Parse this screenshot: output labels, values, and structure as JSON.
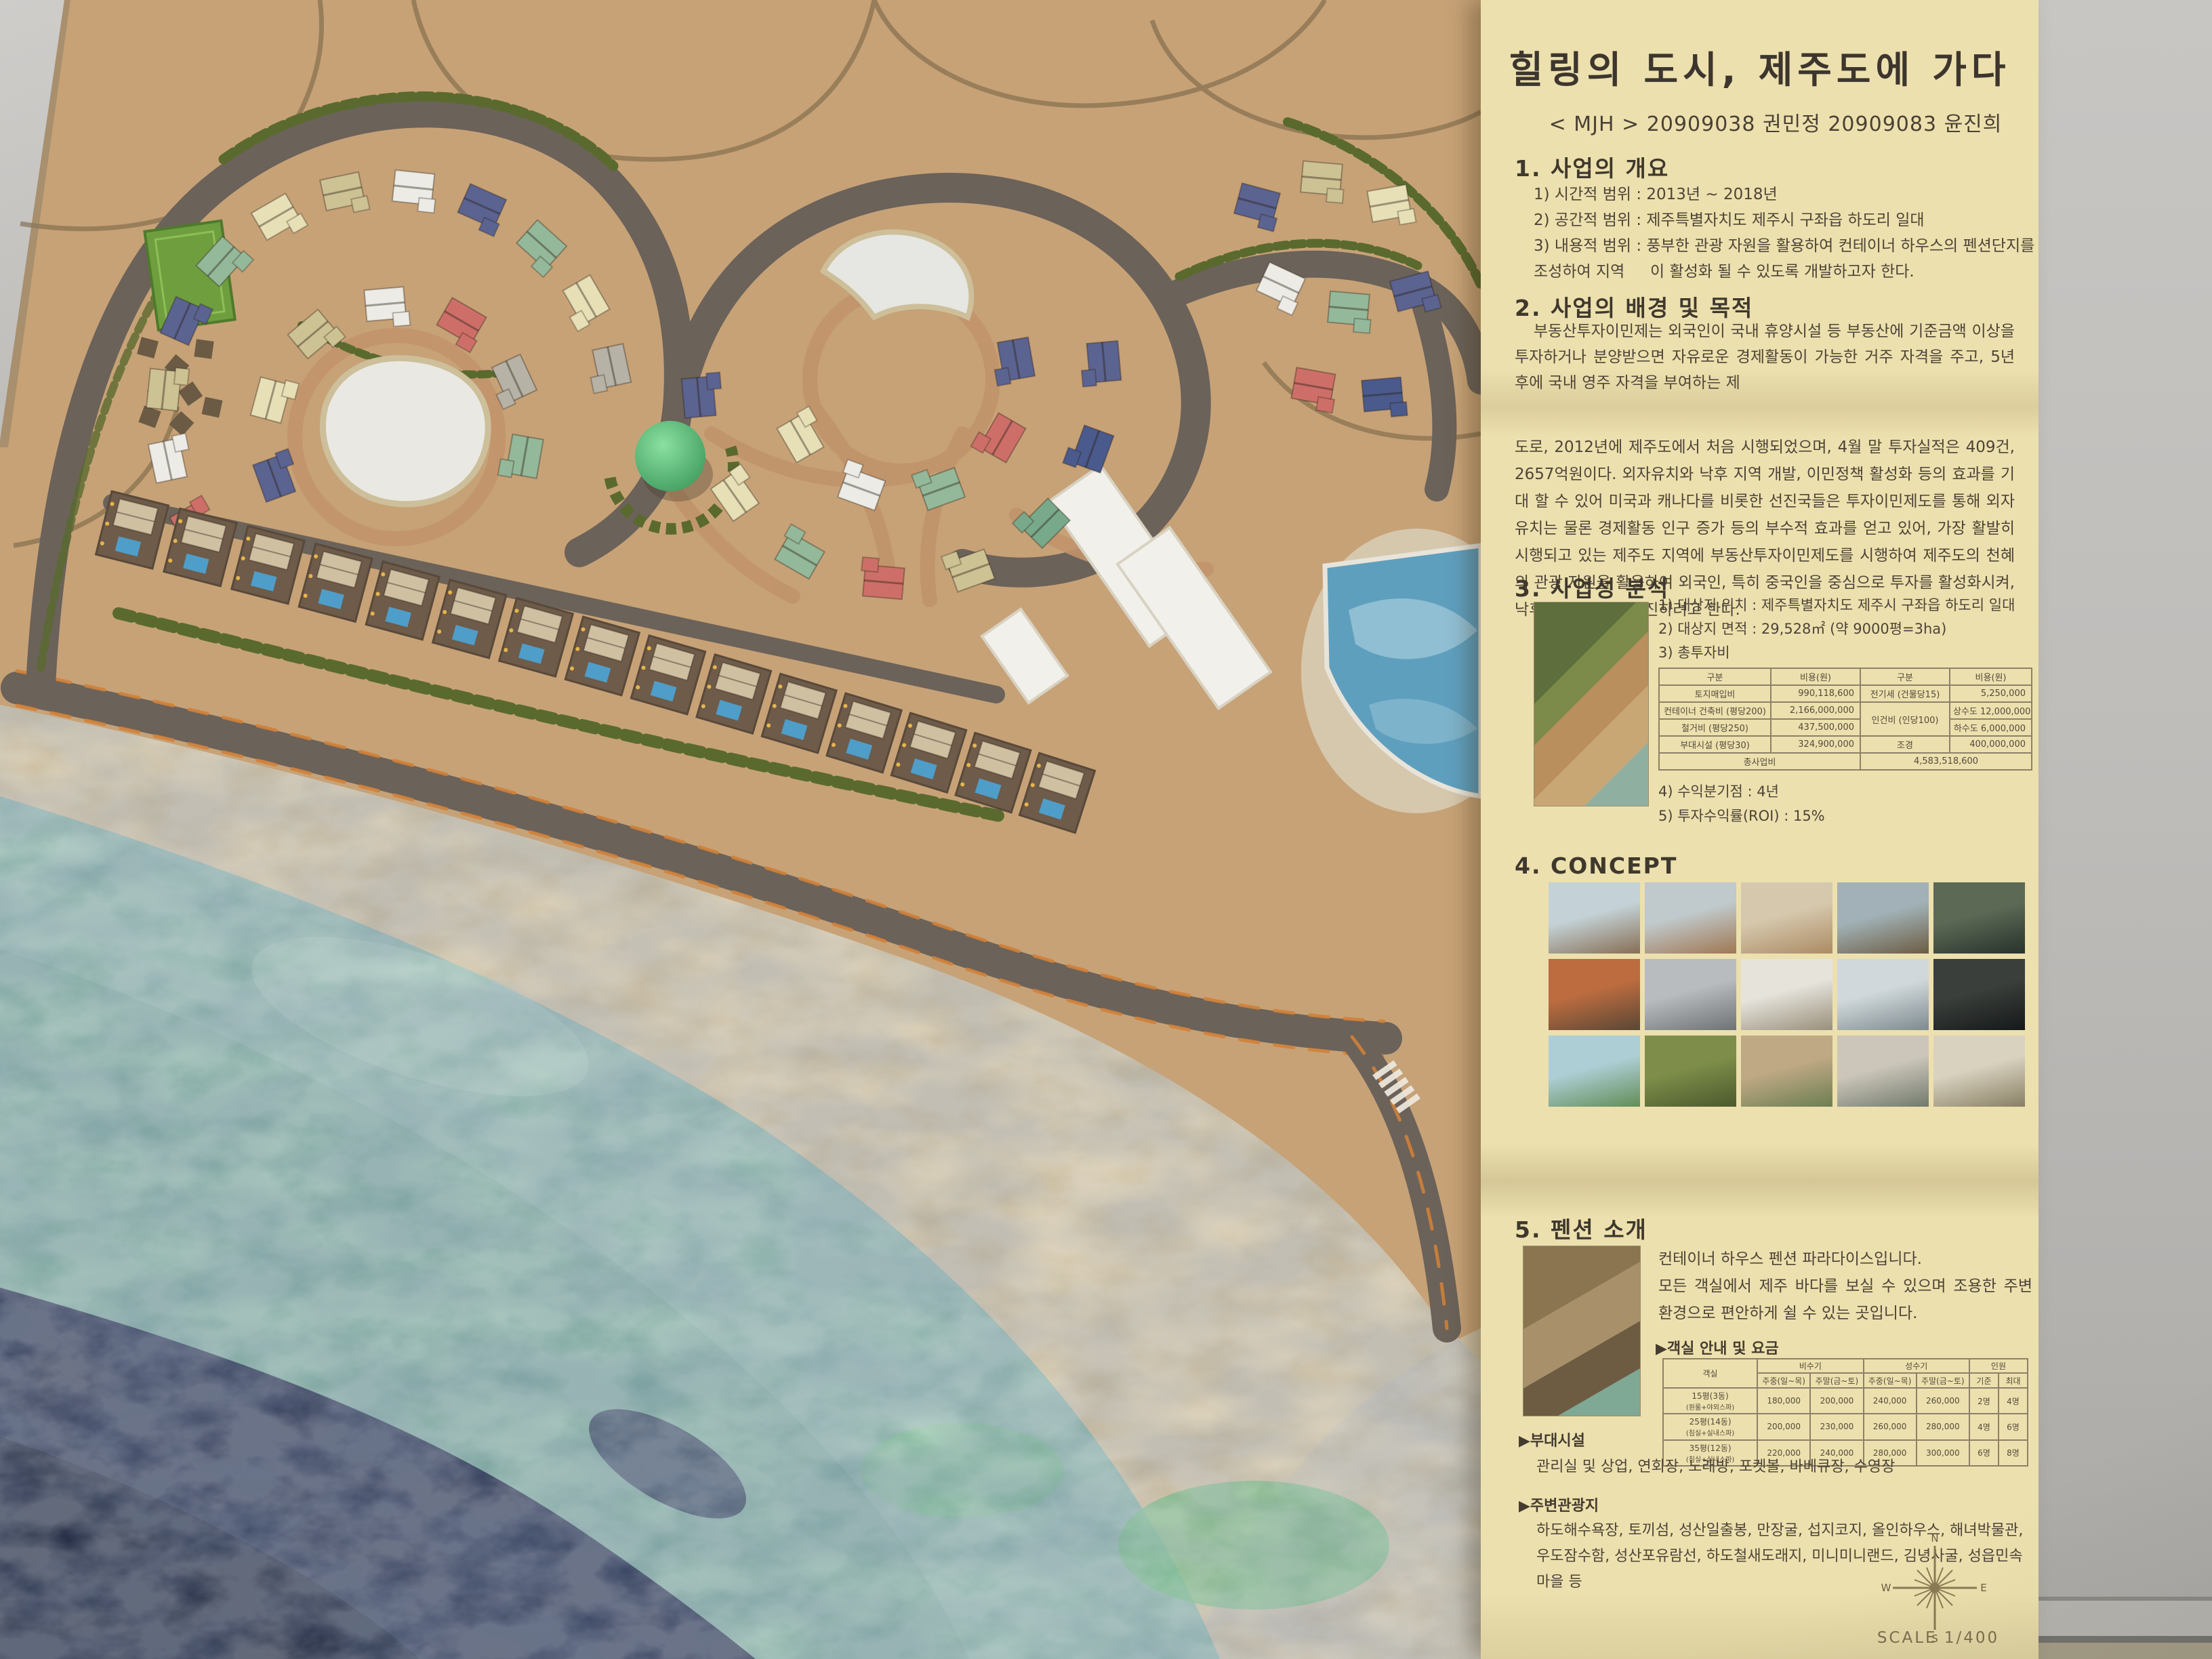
{
  "panel": {
    "title": "힐링의 도시, 제주도에 가다",
    "subtitle": "< MJH > 20909038 권민정 20909083 윤진희",
    "section1": {
      "heading": "1. 사업의 개요",
      "items": [
        "1) 시간적 범위 : 2013년 ~ 2018년",
        "2) 공간적 범위 : 제주특별자치도 제주시 구좌읍 하도리 일대",
        "3) 내용적 범위 : 풍부한 관광 자원을 활용하여 컨테이너 하우스의 펜션단지를 조성하여 지역",
        "이 활성화 될 수 있도록 개발하고자 한다."
      ]
    },
    "section2": {
      "heading": "2. 사업의 배경 및 목적",
      "para1": "부동산투자이민제는 외국인이 국내 휴양시설 등 부동산에 기준금액 이상을 투자하거나 분양받으면 자유로운 경제활동이 가능한 거주 자격을 주고, 5년 후에 국내 영주 자격을 부여하는 제",
      "para2": "도로, 2012년에 제주도에서 처음 시행되었으며, 4월 말 투자실적은 409건, 2657억원이다. 외자유치와 낙후 지역 개발, 이민정책 활성화 등의 효과를 기대 할 수 있어 미국과 캐나다를 비롯한 선진국들은 투자이민제도를 통해 외자유치는 물론 경제활동 인구 증가 등의 부수적 효과를 얻고 있어, 가장 활발히 시행되고 있는 제주도 지역에 부동산투자이민제도를 시행하여 제주도의 천혜의 관광 자원을 활용하여 외국인, 특히 중국인을 중심으로 투자를 활성화시켜, 낙후 지역 개발을 추진하려고 한다."
    },
    "section3": {
      "heading": "3. 사업성 분석",
      "items": [
        "1) 대상지 위치 : 제주특별자치도 제주시 구좌읍 하도리 일대",
        "2) 대상지 면적 : 29,528㎡ (약 9000평=3ha)",
        "3) 총투자비"
      ],
      "cost_table": {
        "headers": [
          "구분",
          "비용(원)",
          "구분",
          "비용(원)"
        ],
        "r0": [
          "토지매입비",
          "990,118,600",
          "전기세 (건물당15)",
          "5,250,000"
        ],
        "r1": [
          "컨테이너 건축비 (평당200)",
          "2,166,000,000",
          "인건비 (인당100)",
          "상수도 12,000,000"
        ],
        "r2": [
          "철거비 (평당250)",
          "437,500,000",
          "하수도 6,000,000"
        ],
        "r3": [
          "부대시설 (평당30)",
          "324,900,000",
          "조경",
          "400,000,000"
        ],
        "total_label": "총사업비",
        "total_value": "4,583,518,600"
      },
      "items2": [
        "4) 수익분기점 : 4년",
        "5) 투자수익률(ROI) : 15%"
      ]
    },
    "section4": {
      "heading": "4. CONCEPT"
    },
    "section5": {
      "heading": "5. 펜션 소개",
      "desc1": "컨테이너 하우스 펜션 파라다이스입니다.",
      "desc2": "모든 객실에서 제주 바다를 보실 수 있으며 조용한 주변 환경으로 편안하게 쉴 수 있는 곳입니다.",
      "room_label": "▶객실 안내 및 요금",
      "room_table": {
        "h1": [
          "객실",
          "비수기",
          "성수기",
          "인원"
        ],
        "h2": [
          "주중(일~목)",
          "주말(금~토)",
          "주중(일~목)",
          "주말(금~토)",
          "기준",
          "최대"
        ],
        "rows": [
          [
            "15평(3동)",
            "(원룸+야외스파)",
            "180,000",
            "200,000",
            "240,000",
            "260,000",
            "2명",
            "4명"
          ],
          [
            "25평(14동)",
            "(침실+실내스파)",
            "200,000",
            "230,000",
            "260,000",
            "280,000",
            "4명",
            "6명"
          ],
          [
            "35평(12동)",
            "(침실+실내스파)",
            "220,000",
            "240,000",
            "280,000",
            "300,000",
            "6명",
            "8명"
          ]
        ]
      }
    },
    "facilities": {
      "label": "▶부대시설",
      "text": "관리실 및 상업, 연회장, 노래방, 포켓볼, 바베큐장, 수영장"
    },
    "attractions": {
      "label": "▶주변관광지",
      "text": "하도해수욕장, 토끼섬, 성산일출봉, 만장굴, 섭지코지, 올인하우스, 해녀박물관, 우도잠수함, 성산포유람선, 하도철새도래지, 미니미니랜드, 김녕사굴, 성읍민속마을 등"
    },
    "compass": {
      "n": "N",
      "e": "E",
      "s": "S",
      "w": "W"
    },
    "scale_label": "SCALE 1/400"
  },
  "colors": {
    "panel_bg": "#ece0ae",
    "land": "#c7a277",
    "road": "#6b6259",
    "road_edge_orange": "#d08138",
    "beach_sand": "#d9c69f",
    "sea_teal": "#8fb8ab",
    "sea_dark": "#232c49",
    "pond_white": "#e9e8e3",
    "hedge_green": "#5a6a2e",
    "tree_green": "#58c37e",
    "court_green": "#6f9e3f",
    "pool_blue": "#4f9dc9",
    "houses": {
      "slate": "#5b6391",
      "blue": "#4a5a8c",
      "green": "#94b89a",
      "teal": "#79a98b",
      "cream": "#e7e0b6",
      "red": "#cd6f68",
      "white": "#ecebe5",
      "khaki": "#cdc293",
      "gray": "#b7b2a6",
      "tan": "#d3c3a0"
    }
  }
}
